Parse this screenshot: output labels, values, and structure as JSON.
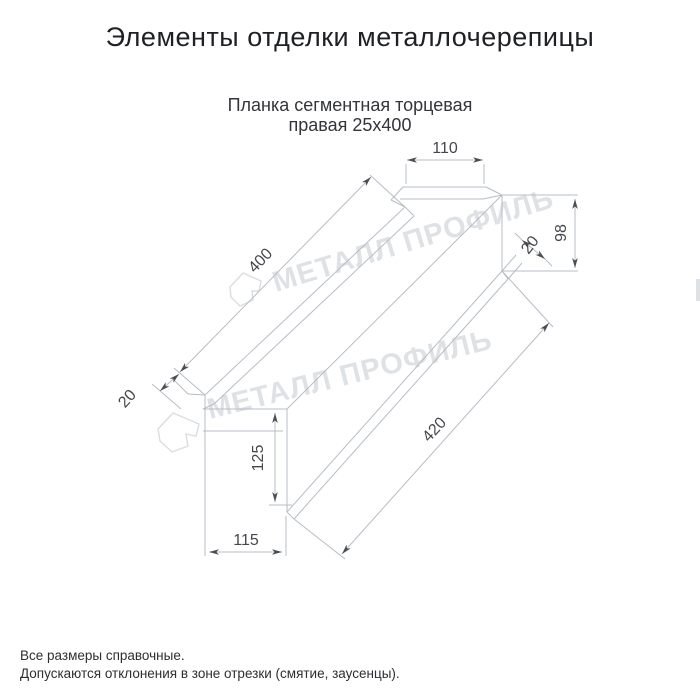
{
  "page": {
    "title": "Элементы отделки металлочерепицы",
    "subtitle_line1": "Планка сегментная торцевая",
    "subtitle_line2": "правая 25х400",
    "footnote_line1": "Все размеры справочные.",
    "footnote_line2": "Допускаются отклонения в зоне отрезки (смятие, заусенцы)."
  },
  "drawing": {
    "watermark_text": "МЕТАЛЛ ПРОФИЛЬ",
    "dimensions": {
      "top_flange_width": "110",
      "right_end_height": "98",
      "right_hem": "20",
      "upper_edge_length": "400",
      "left_hem": "20",
      "left_end_height": "125",
      "bottom_width": "115",
      "lower_edge_length": "420"
    },
    "colors": {
      "line": "#b7bdc5",
      "dimension_text": "#44474c",
      "watermark": "#d8dbdf"
    }
  }
}
